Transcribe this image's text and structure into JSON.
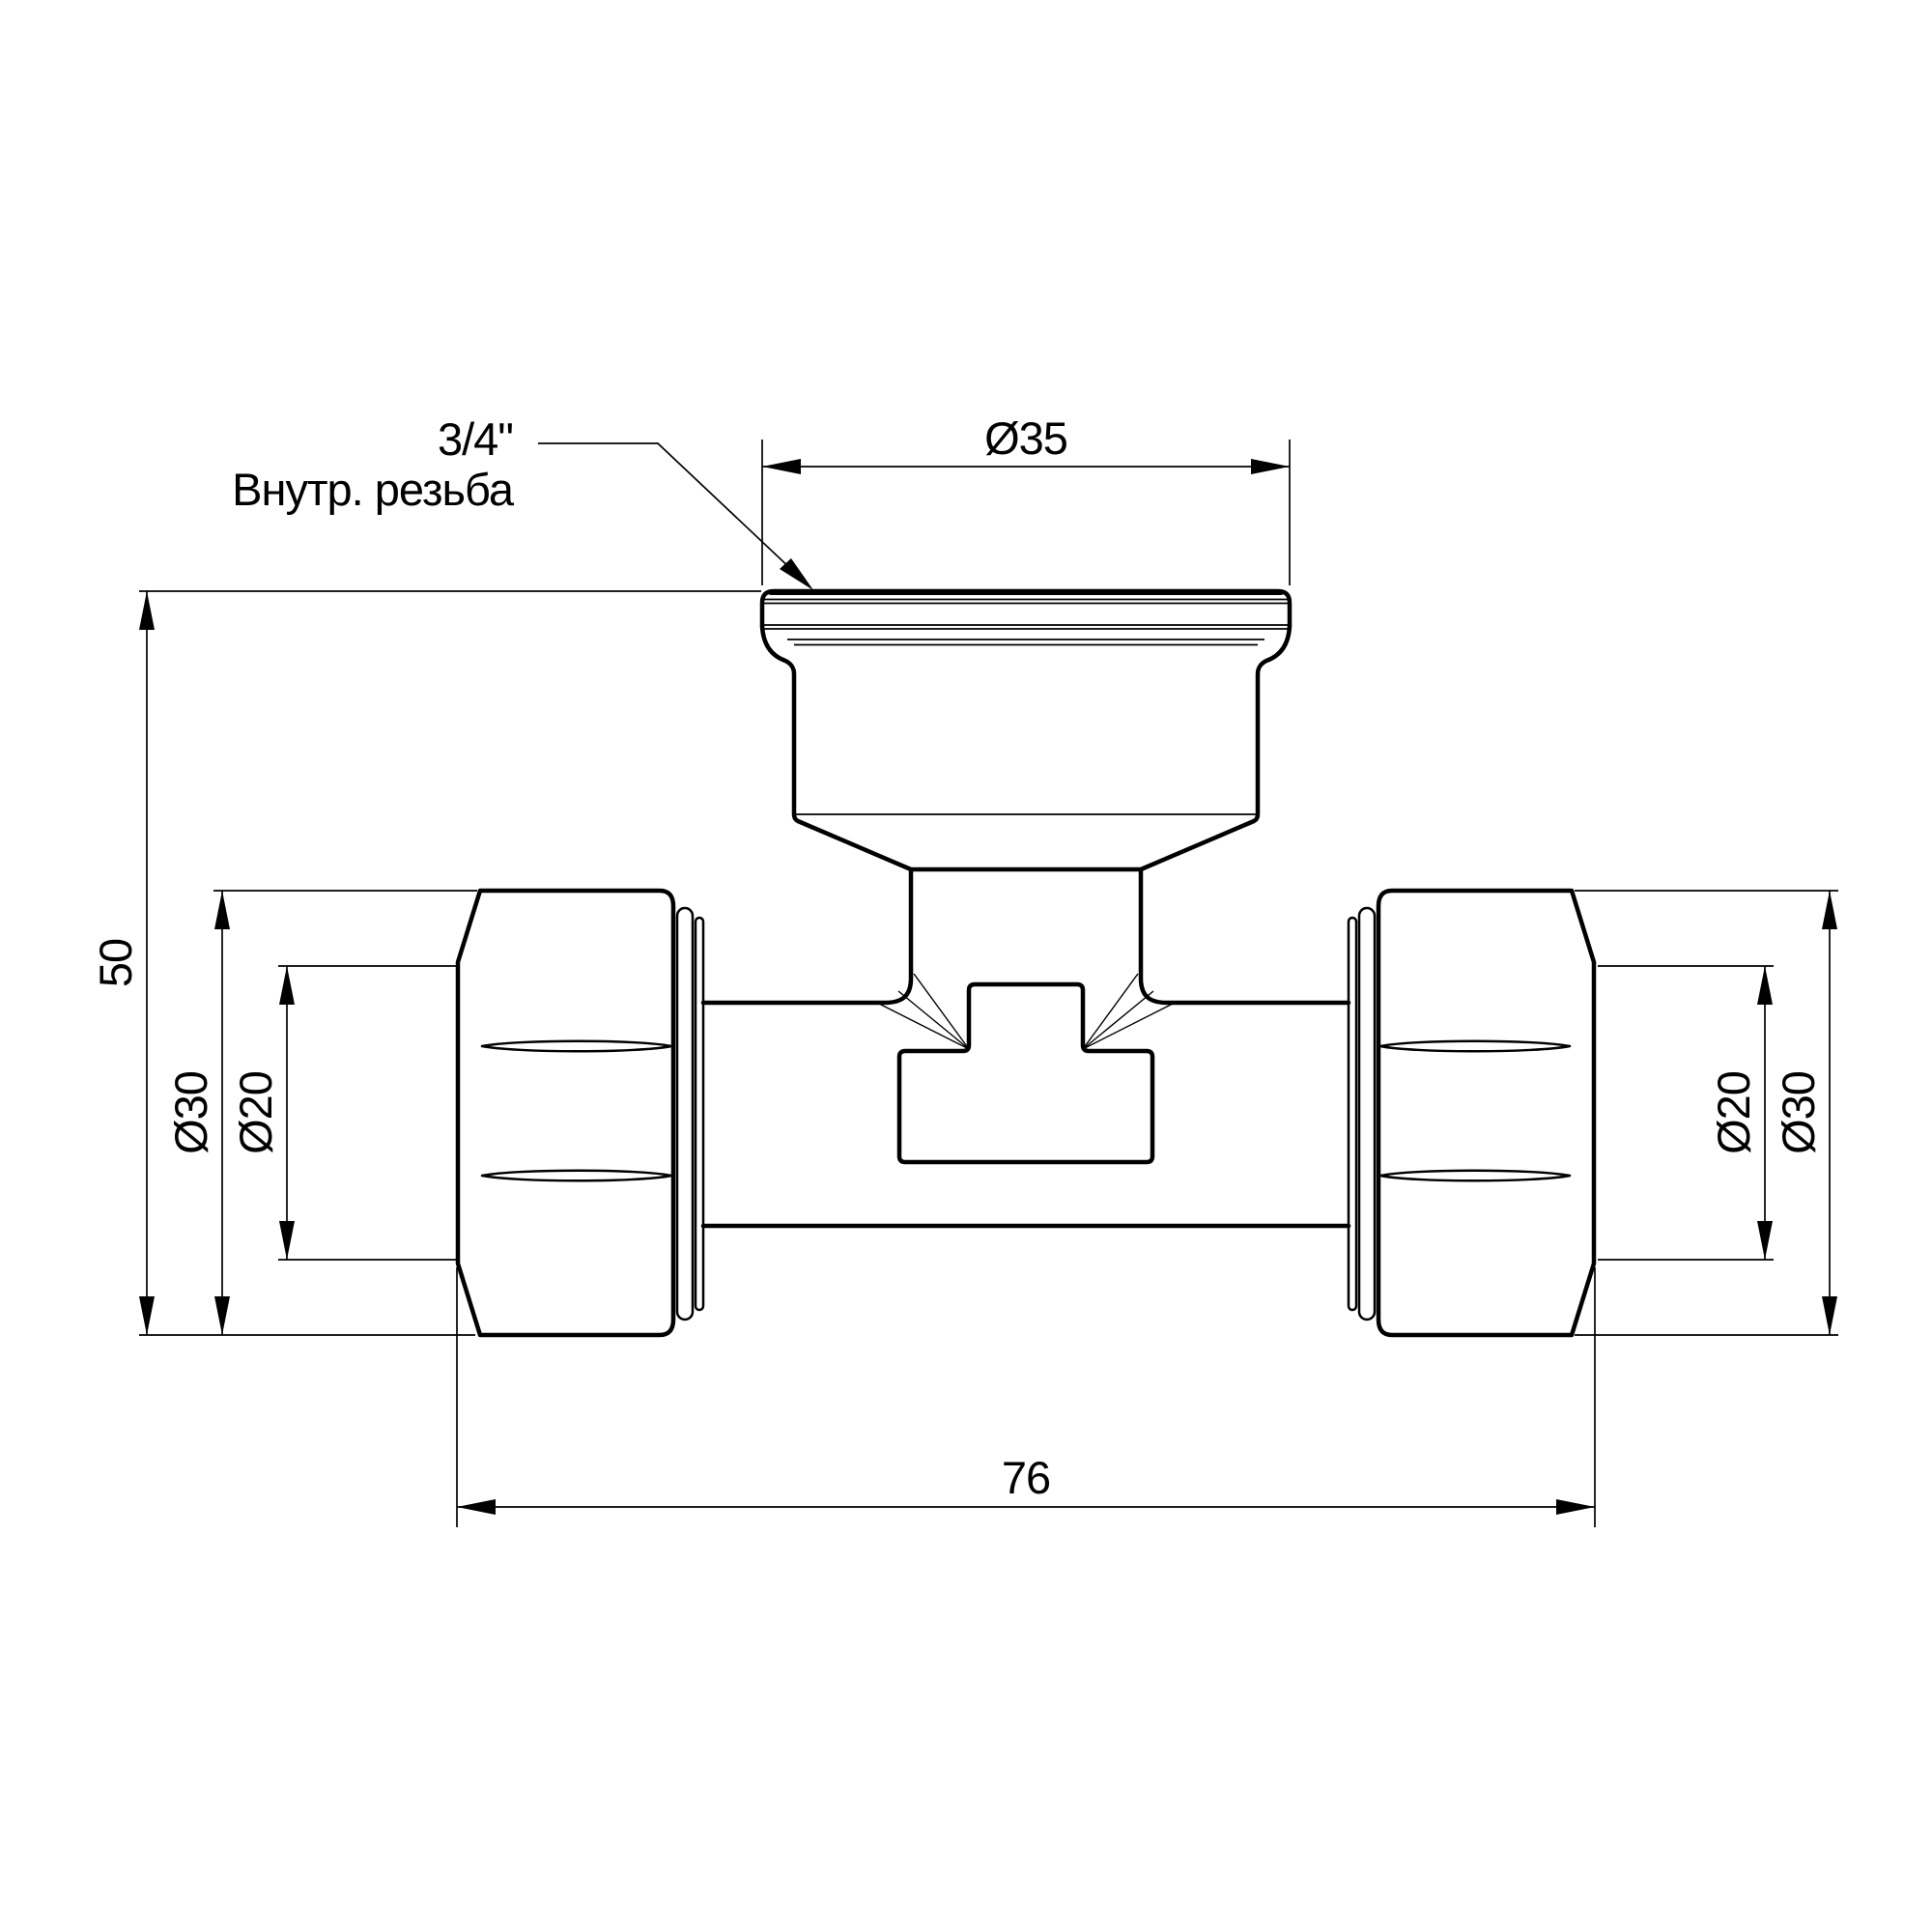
{
  "drawing": {
    "type": "technical-drawing",
    "part": "tee compression fitting, front view",
    "units": "mm"
  },
  "callout": {
    "line1": "3/4\"",
    "line2": "Внутр. резьба"
  },
  "dimensions": {
    "top_port_diameter": {
      "label": "Ø35",
      "value_mm": 35
    },
    "overall_height": {
      "label": "50",
      "value_mm": 50
    },
    "left_nut": {
      "label": "Ø30",
      "value_mm": 30
    },
    "left_pipe": {
      "label": "Ø20",
      "value_mm": 20
    },
    "right_pipe": {
      "label": "Ø20",
      "value_mm": 20
    },
    "right_nut": {
      "label": "Ø30",
      "value_mm": 30
    },
    "overall_length": {
      "label": "76",
      "value_mm": 76
    }
  },
  "colors": {
    "line": "#000000",
    "background": "#ffffff"
  }
}
